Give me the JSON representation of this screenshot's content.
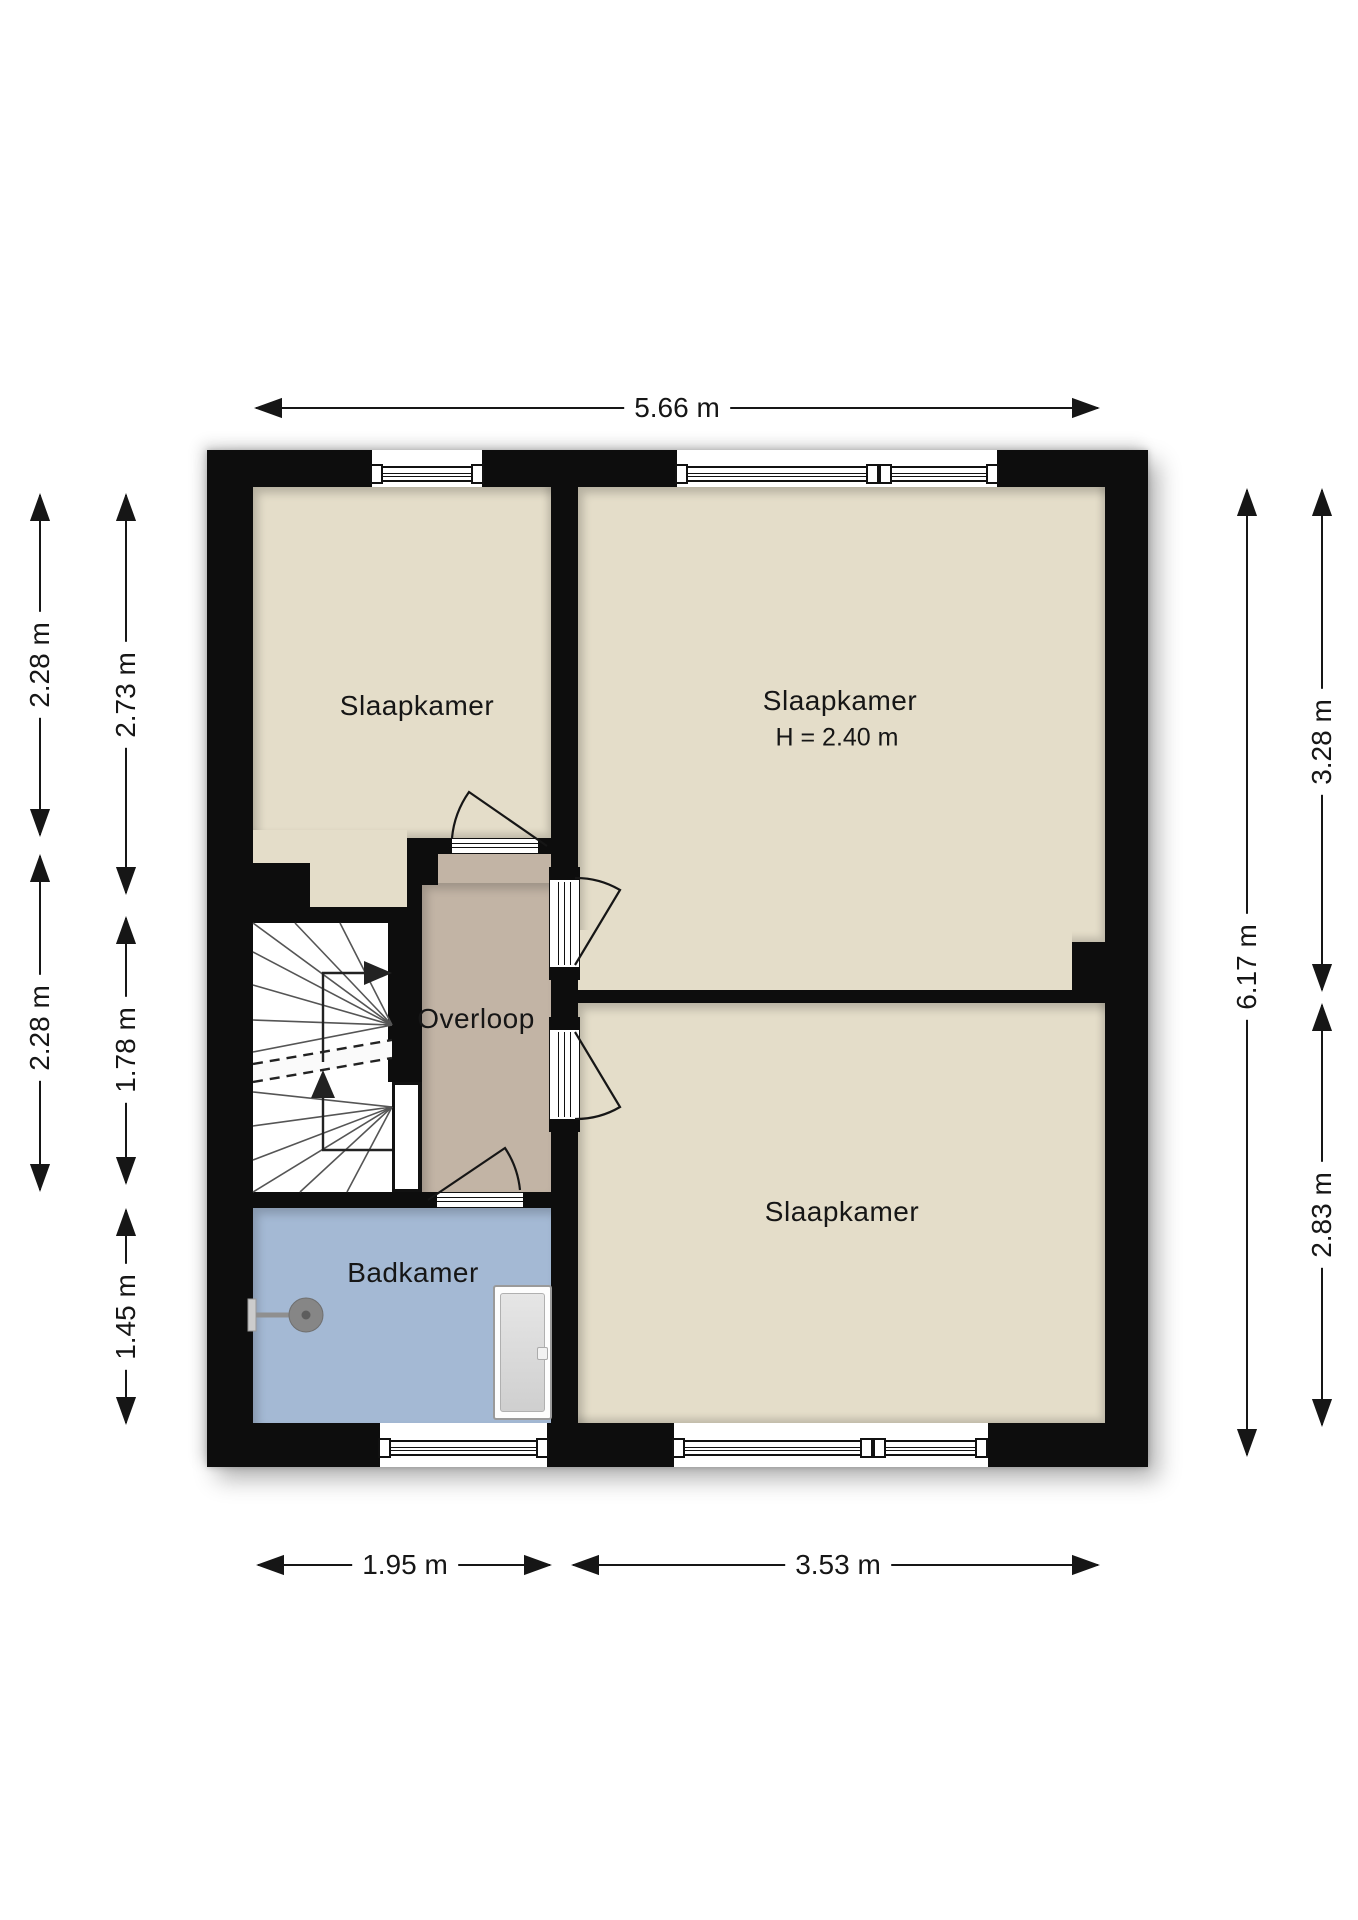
{
  "plan_title": "Floor plan – first floor (verdieping)",
  "rooms": {
    "bedroom_top_left": {
      "label": "Slaapkamer"
    },
    "bedroom_top_right": {
      "label": "Slaapkamer",
      "height_note": "H = 2.40 m"
    },
    "landing": {
      "label": "Overloop"
    },
    "bathroom": {
      "label": "Badkamer"
    },
    "bedroom_bottom": {
      "label": "Slaapkamer"
    }
  },
  "dimensions": {
    "top_width": "5.66 m",
    "bottom_width_left": "1.95 m",
    "bottom_width_right": "3.53 m",
    "left_outer_upper": "2.28 m",
    "left_outer_lower": "2.28 m",
    "left_inner_upper": "2.73 m",
    "left_inner_middle": "1.78 m",
    "left_inner_lower": "1.45 m",
    "right_inner_full": "6.17 m",
    "right_outer_upper": "3.28 m",
    "right_outer_lower": "2.83 m"
  },
  "fixtures": {
    "shower": "shower-head-icon",
    "bathtub": "bathtub-icon",
    "stairs": "winder-stairs-up"
  },
  "colors": {
    "wall": "#0d0d0d",
    "bedroom_floor": "#e4ddc9",
    "landing_floor": "#c2b4a5",
    "bathroom_floor": "#a4b9d4",
    "stairs_floor": "#ffffff",
    "line": "#161616",
    "background": "#ffffff"
  }
}
